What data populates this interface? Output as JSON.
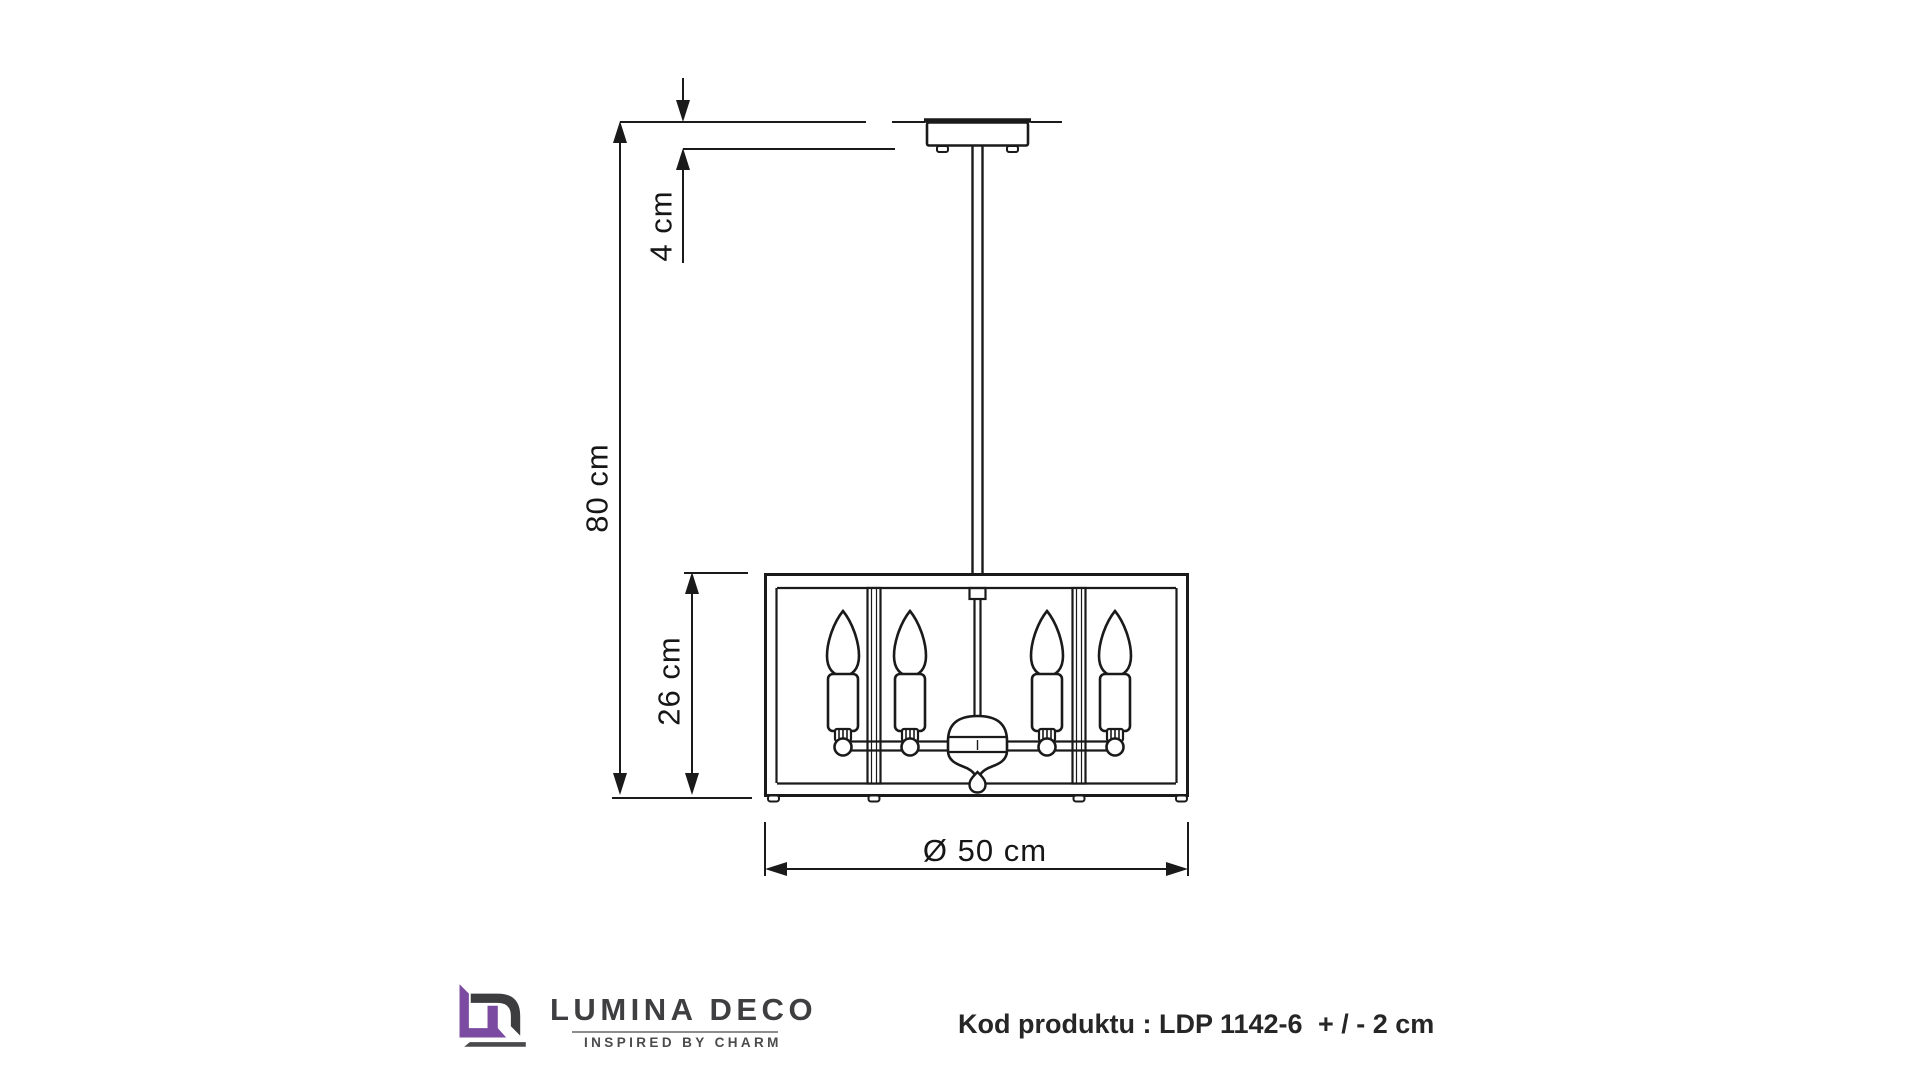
{
  "page": {
    "background": "#ffffff",
    "line_color": "#1a1a1a"
  },
  "diagram": {
    "labels": {
      "offset": "4 cm",
      "height": "80 cm",
      "shade": "26 cm",
      "diameter": "Ø 50 cm"
    }
  },
  "footer": {
    "brand": "LUMINA DECO",
    "tagline": "INSPIRED BY CHARM",
    "logo_colors": {
      "purple": "#7a4ba1",
      "gray": "#3d3d40"
    },
    "product_code": "Kod produktu : LDP 1142-6",
    "tolerance": "+ / - 2 cm"
  }
}
